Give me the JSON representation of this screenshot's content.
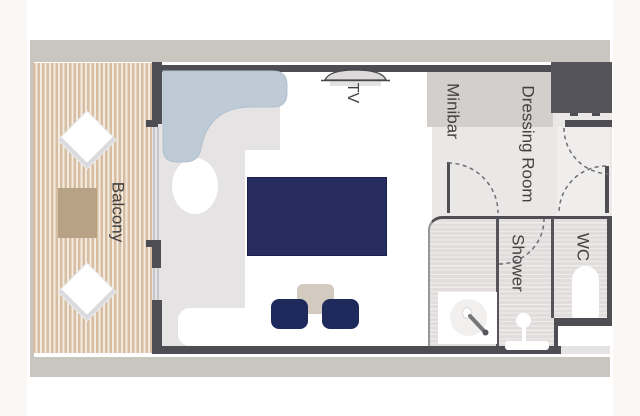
{
  "labels": {
    "balcony": "Balcony",
    "tv": "TV",
    "minibar": "Minibar",
    "dressing_room": "Dressing Room",
    "shower": "Shower",
    "wc": "WC"
  },
  "colors": {
    "page_background": "#FBF7F4",
    "plan_canvas": "#FFFFFF",
    "hull_band": "#C9C6C0",
    "wall": "#4E4D53",
    "structure_block": "#55545A",
    "cabin_floor": "#E5E3E4",
    "dressing_floor": "#EAE8E7",
    "bathroom_floor_stripe": "#E0DDDC",
    "deck_stripe": "#D7BDA1",
    "deck_stripe_gap": "#F3EBE0",
    "sofa": "#BECBD6",
    "bed_duvet": "#272E5F",
    "chair": "#1F2A5C",
    "seat_table": "#D3CBC0",
    "balcony_table": "#B7A286",
    "minibar_cabinet": "#D2CFCC",
    "label_text": "#434241",
    "door_swing_dash": "#6E6D72"
  }
}
